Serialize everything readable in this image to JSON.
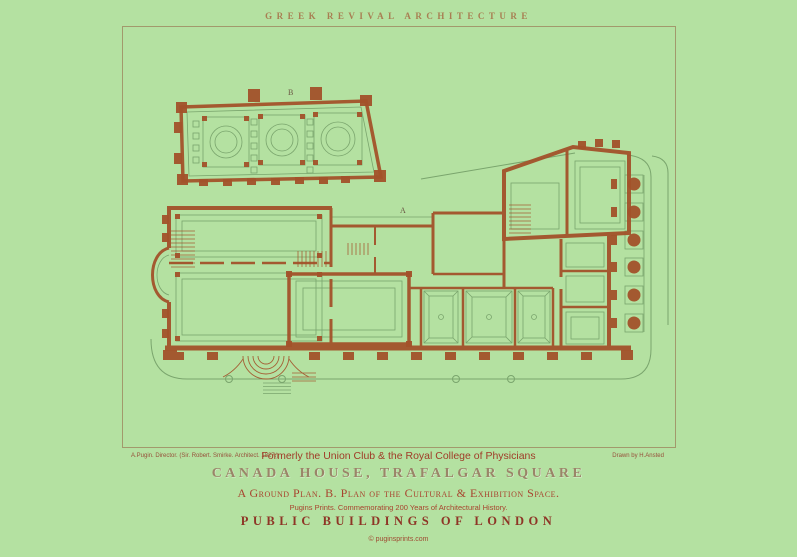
{
  "header": {
    "title": "GREEK REVIVAL ARCHITECTURE"
  },
  "plan": {
    "label_a": "A",
    "label_b": "B"
  },
  "captions": {
    "credit_left": "A.Pugin. Director. (Sir. Robert. Smirke. Architect. 1827.)",
    "subtitle": "Formerly the Union Club & the Royal College of Physicians",
    "credit_right": "Drawn by H.Ansted",
    "title": "CANADA HOUSE, TRAFALGAR SQUARE",
    "plan_key": "A Ground Plan. B. Plan of the Cultural & Exhibition Space.",
    "series_note": "Pugins Prints. Commemorating 200 Years of Architectural History.",
    "series_title": "PUBLIC BUILDINGS OF LONDON",
    "copyright": "© puginsprints.com"
  },
  "colors": {
    "background": "#b4e1a1",
    "frame_line": "#a2996c",
    "plan_walls_rust": "#a3522a",
    "plan_detail_green": "#7aa56d",
    "title_brown": "#a87e52",
    "caption_red": "#a03c28",
    "heading_taupe": "#9a8568",
    "footer_maroon": "#8e3526"
  }
}
